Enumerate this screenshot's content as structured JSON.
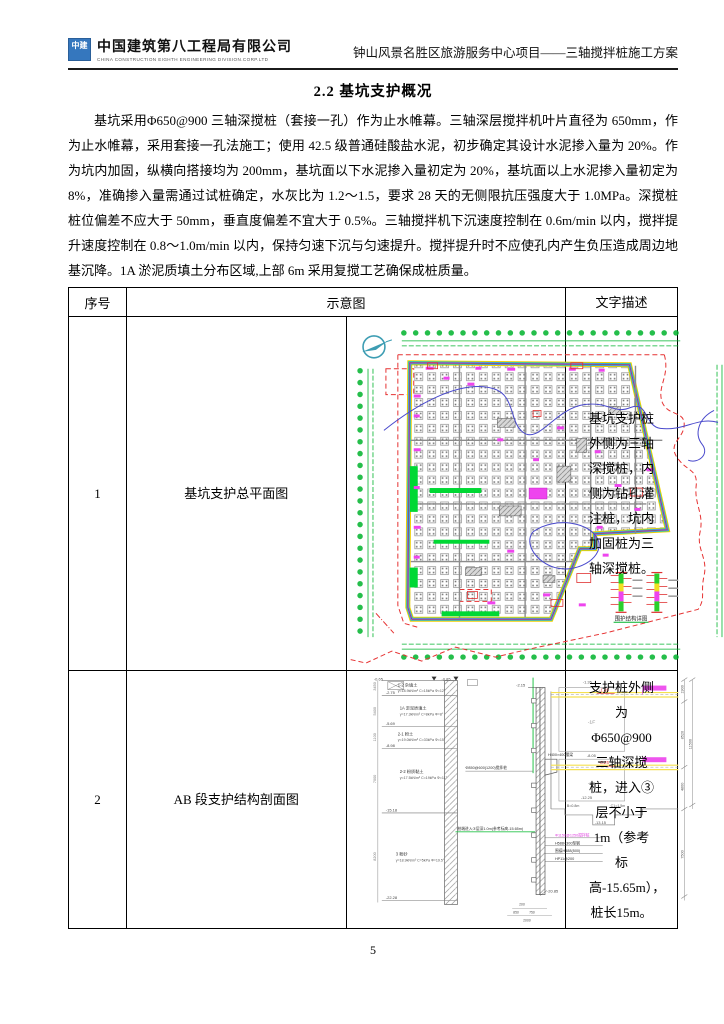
{
  "palette": {
    "logo_blue": "#3577be",
    "cad_green": "#00b32c",
    "cad_magenta": "#ee44ee",
    "cad_red": "#e63232",
    "cad_cyan": "#00c8d8",
    "cad_yellow": "#f0d000",
    "cad_blue": "#4848cc"
  },
  "header": {
    "logo_mark": "中建",
    "logo_cn": "中国建筑第八工程局有限公司",
    "logo_en": "CHINA CONSTRUCTION EIGHTH ENGINEERING DIVISION.CORP.LTD",
    "doc_title": "钟山风景名胜区旅游服务中心项目——三轴搅拌桩施工方案"
  },
  "heading": "2.2  基坑支护概况",
  "paragraph": "基坑采用Φ650@900 三轴深搅桩（套接一孔）作为止水帷幕。三轴深层搅拌机叶片直径为 650mm，作为止水帷幕，采用套接一孔法施工；使用 42.5 级普通硅酸盐水泥，初步确定其设计水泥掺入量为 20%。作为坑内加固，纵横向搭接均为 200mm，基坑面以下水泥掺入量初定为 20%，基坑面以上水泥掺入量初定为 8%，准确掺入量需通过试桩确定，水灰比为 1.2～1.5，要求 28 天的无侧限抗压强度大于 1.0MPa。深搅桩桩位偏差不应大于 50mm，垂直度偏差不宜大于 0.5%。三轴搅拌机下沉速度控制在 0.6m/min 以内，搅拌提升速度控制在 0.8～1.0m/min 以内，保持匀速下沉与匀速提升。搅拌提升时不应使孔内产生负压造成周边地基沉降。1A 淤泥质填土分布区域,上部 6m 采用复搅工艺确保成桩质量。",
  "table": {
    "headers": {
      "no": "序号",
      "diagram": "示意图",
      "description": "文字描述"
    },
    "rows": [
      {
        "no": "1",
        "label": "基坑支护总平面图",
        "description": "基坑支护桩外侧为三轴深搅桩，内侧为钻孔灌注桩，坑内加固桩为三轴深搅桩。"
      },
      {
        "no": "2",
        "label": "AB 段支护结构剖面图",
        "description": "支护桩外侧为Φ650@900三轴深搅桩，进入③层不小于1m（参考标高-15.65m），桩长15m。"
      }
    ]
  },
  "plan": {
    "detail_label": "围护结构详图"
  },
  "section": {
    "top_elevs": [
      "-0.65",
      "-0.85"
    ],
    "soil": {
      "layers": [
        {
          "name": "1-2 杂填土",
          "params": "γ=18.9kN/m³ C=15kPa Φ=12°",
          "bottom_elev": "-2.75",
          "thickness": "3450"
        },
        {
          "name": "1A 淤泥质填土",
          "params": "γ=17.3kN/m³ C=8kPa Φ=8°",
          "bottom_elev": "-5.69",
          "thickness": "5400"
        },
        {
          "name": "2-1 粉土",
          "params": "γ=19.0kN/m³ C=33kPa Φ=15°",
          "bottom_elev": "-8.98",
          "thickness": "1100"
        },
        {
          "name": "2-2 粉质黏土",
          "params": "γ=17.5kN/m³ C=19kPa Φ=11°",
          "bottom_elev": "-15.18",
          "thickness": "7000"
        },
        {
          "name": "3 粉砂",
          "params": "γ=18.9kN/m³ C=5kPa Φ=19.5°",
          "bottom_elev": "-22.28",
          "thickness": "8200"
        }
      ]
    },
    "pile": {
      "top_elev": "-2.15",
      "bottom_elev": "-20.85",
      "label": "Φ850@600(1200)搅拌桩",
      "bracket_label": "H400×400腰梁",
      "toe_note": "桩端进入③层深1.0m(参考标高-15.65m)",
      "callouts": [
        "Φ1150@1250搅拌桩",
        "H588×300型钢",
        "围檩H488(500)",
        "HP11@200"
      ]
    },
    "basement": {
      "floor1": "-1F",
      "floor2": "-2F",
      "elev_top": "-1.35",
      "elev_f1": "-1.85",
      "elev_mid": "-8.05",
      "elev_f2": "-8.25",
      "elev_low": "-12.25",
      "elev_pit": "-13.15",
      "b_dim": "B=0.8m",
      "c_dim": "C1=1.5m"
    },
    "dims_right": [
      "1900",
      "8520",
      "11500",
      "4800",
      "7500"
    ],
    "dims_bottom": [
      "200",
      "850",
      "750",
      "2000"
    ]
  },
  "page_number": "5"
}
